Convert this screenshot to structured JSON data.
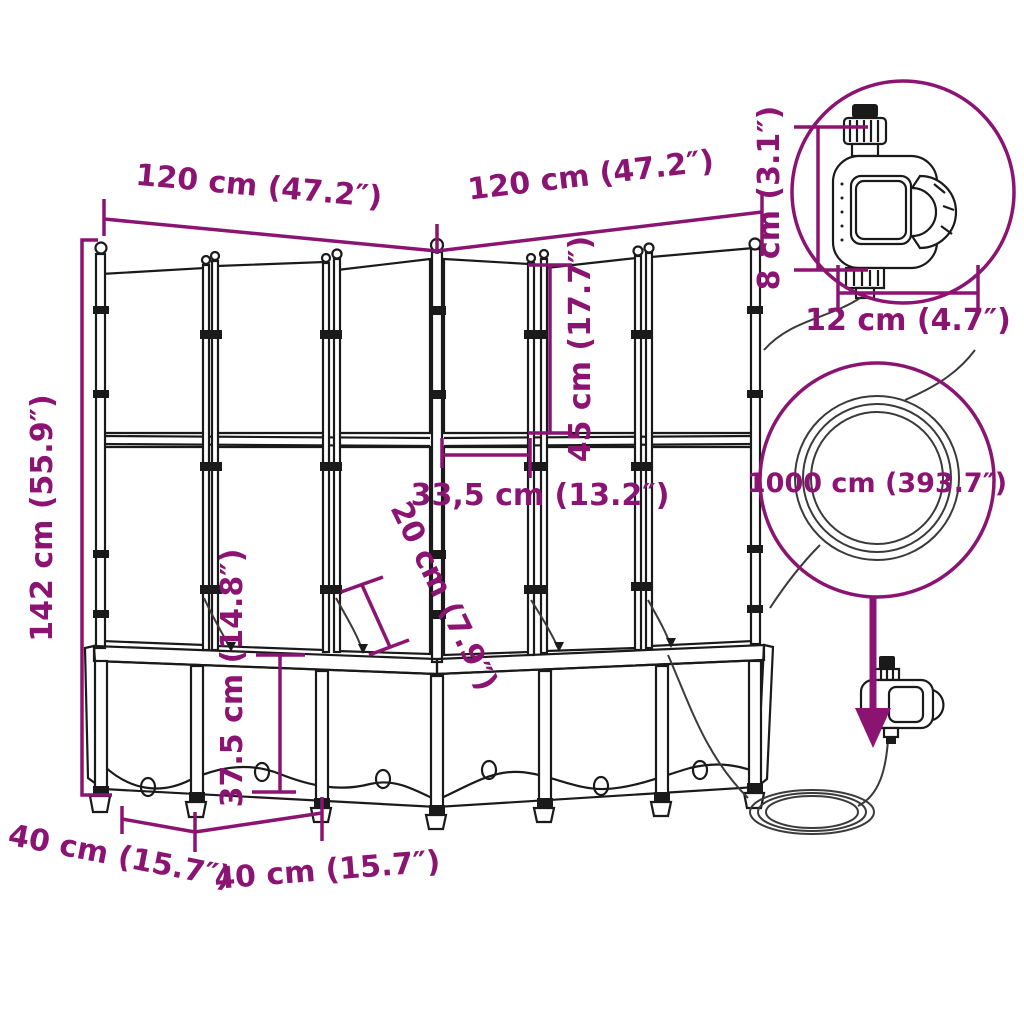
{
  "page": {
    "background": "#ffffff",
    "accent_color": "#8B1473",
    "line_color": "#1a1a1a"
  },
  "labels": {
    "width_left": "120 cm (47.2″)",
    "width_right": "120 cm (47.2″)",
    "total_height": "142 cm (55.9″)",
    "trellis_section_height": "45 cm (17.7″)",
    "corner_panel_width": "33,5 cm (13.2″)",
    "inner_depth": "20 cm (7.9″)",
    "planter_box_height": "37.5 cm (14.8″)",
    "base_depth_left": "40 cm (15.7″)",
    "base_depth_right": "40 cm (15.7″)",
    "timer_height": "8 cm (3.1″)",
    "timer_width": "12 cm (4.7″)",
    "hose_length": "1000 cm (393.7″)"
  }
}
